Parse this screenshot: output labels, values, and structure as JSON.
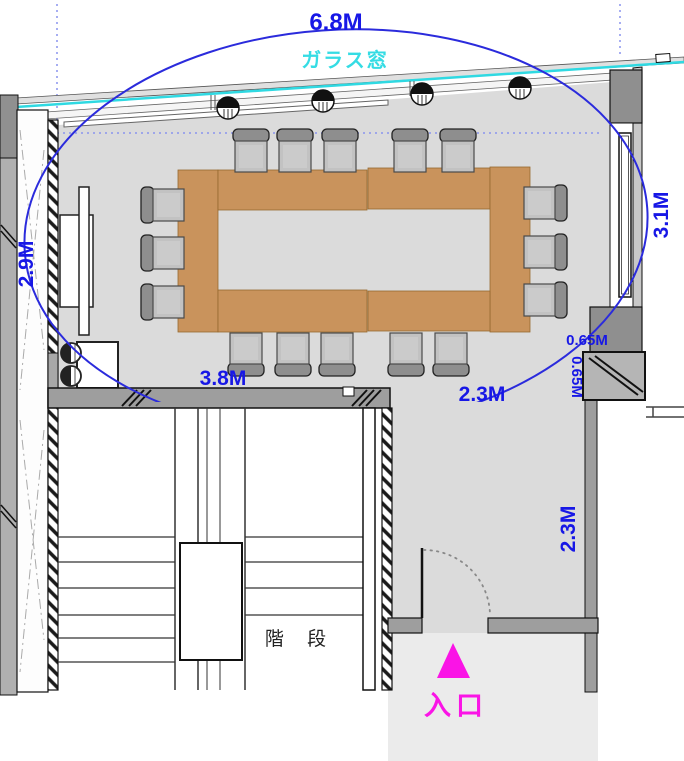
{
  "dimensions": {
    "top_width": "6.8M",
    "left_depth": "2.9M",
    "right_depth": "3.1M",
    "table_span": "3.8M",
    "lower_width": "2.3M",
    "corner_width": "0.65M",
    "corner_depth": "0.65M",
    "corridor_depth": "2.3M"
  },
  "labels": {
    "glass_window": "ガラス窓",
    "stairs": "階 段",
    "entrance": "入口"
  },
  "colors": {
    "dimension_text": "#1717E6",
    "glass_window": "#2FD9E2",
    "entrance_accent": "#FA14E6",
    "table_fill": "#C9935C",
    "floor_fill": "#DBDBDB",
    "span_ellipse": "#2B2BDC"
  },
  "furniture": {
    "conference_table_segments": 6,
    "chairs": 16,
    "stools": 2,
    "pendant_lights": 4
  }
}
